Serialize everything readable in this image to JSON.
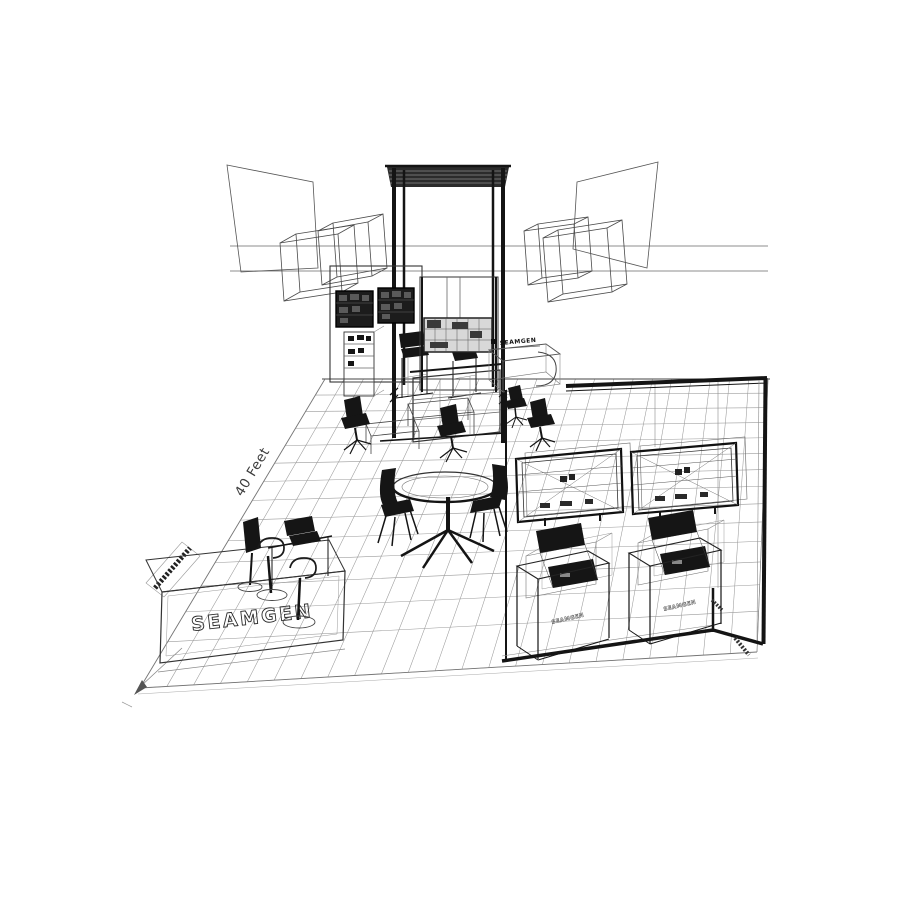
{
  "artwork": {
    "background": "#ffffff",
    "ink_color": "#141414",
    "grid_color": "#9a9a9a",
    "labels": {
      "floor_dimension": "40 Feet",
      "brand_counter": "SEAMGEN",
      "brand_kiosk_sign": "SEAMGEN",
      "brand_demo_station_left": "SEAMGEN",
      "brand_demo_station_right": "SEAMGEN"
    }
  }
}
